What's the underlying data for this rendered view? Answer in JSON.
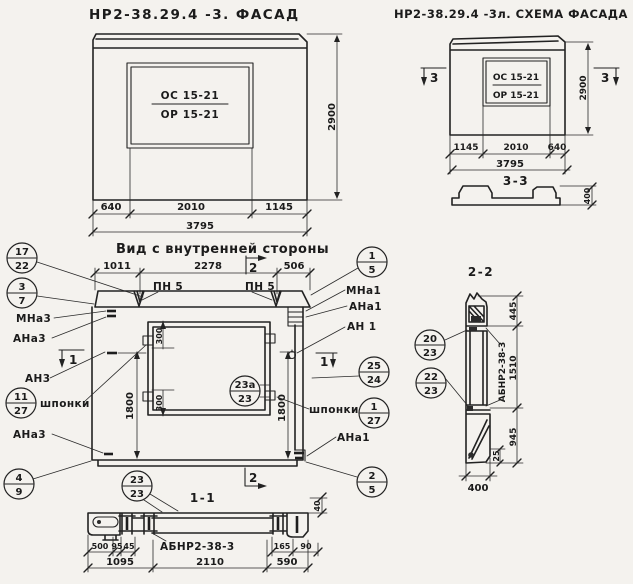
{
  "facade": {
    "title": "НР2-38.29.4 -3. ФАСАД",
    "mark_top": "ОС 15-21",
    "mark_bot": "ОР 15-21",
    "dim_h": "2900",
    "dim_b1": "640",
    "dim_b2": "2010",
    "dim_b3": "1145",
    "dim_total": "3795"
  },
  "schema": {
    "title": "НР2-38.29.4 -3л. СХЕМА ФАСАДА",
    "mark_top": "ОС 15-21",
    "mark_bot": "ОР 15-21",
    "sec_l": "3",
    "sec_r": "3",
    "dim_h": "2900",
    "dim_b1": "1145",
    "dim_b2": "2010",
    "dim_b3": "640",
    "dim_total": "3795",
    "sec_title": "3-3",
    "dim_400": "400"
  },
  "inner": {
    "title": "Вид с внутренней стороны",
    "dim_t1": "1011",
    "dim_t2": "2278",
    "dim_t3": "506",
    "pn1": "ПН 5",
    "pn2": "ПН 5",
    "m1": "1",
    "m2": "2",
    "c17_22": {
      "t": "17",
      "b": "22"
    },
    "c3_7": {
      "t": "3",
      "b": "7"
    },
    "c11_27": {
      "t": "11",
      "b": "27"
    },
    "c4_9": {
      "t": "4",
      "b": "9"
    },
    "c1_5": {
      "t": "1",
      "b": "5"
    },
    "c25_24": {
      "t": "25",
      "b": "24"
    },
    "c1_27": {
      "t": "1",
      "b": "27"
    },
    "c2_5": {
      "t": "2",
      "b": "5"
    },
    "c23a_23": {
      "t": "23а",
      "b": "23"
    },
    "c23_23": {
      "t": "23",
      "b": "23"
    },
    "mna3": "МНа3",
    "ana3": "АНа3",
    "an3": "АН3",
    "shponki_l": "шпонки",
    "ana3_2": "АНа3",
    "mna1": "МНа1",
    "ana1": "АНа1",
    "an1": "АН 1",
    "shponki_r": "шпонки",
    "ana1_2": "АНа1",
    "dim_1800_l": "1800",
    "dim_1800_r": "1800",
    "dim_300_t": "300",
    "dim_300_b": "300"
  },
  "sec22": {
    "title": "2-2",
    "c20_23": {
      "t": "20",
      "b": "23"
    },
    "c22_23": {
      "t": "22",
      "b": "23"
    },
    "label": "АБНР2-38-3",
    "dim_445": "445",
    "dim_1510": "1510",
    "dim_945": "945",
    "dim_25": "25",
    "dim_400": "400"
  },
  "sec11": {
    "title": "1-1",
    "label": "АБНР2-38-3",
    "dim_500": "500",
    "dim_95": "95",
    "dim_45": "45",
    "dim_1095": "1095",
    "dim_2110": "2110",
    "dim_165": "165",
    "dim_90": "90",
    "dim_590": "590",
    "dim_40": "40"
  }
}
